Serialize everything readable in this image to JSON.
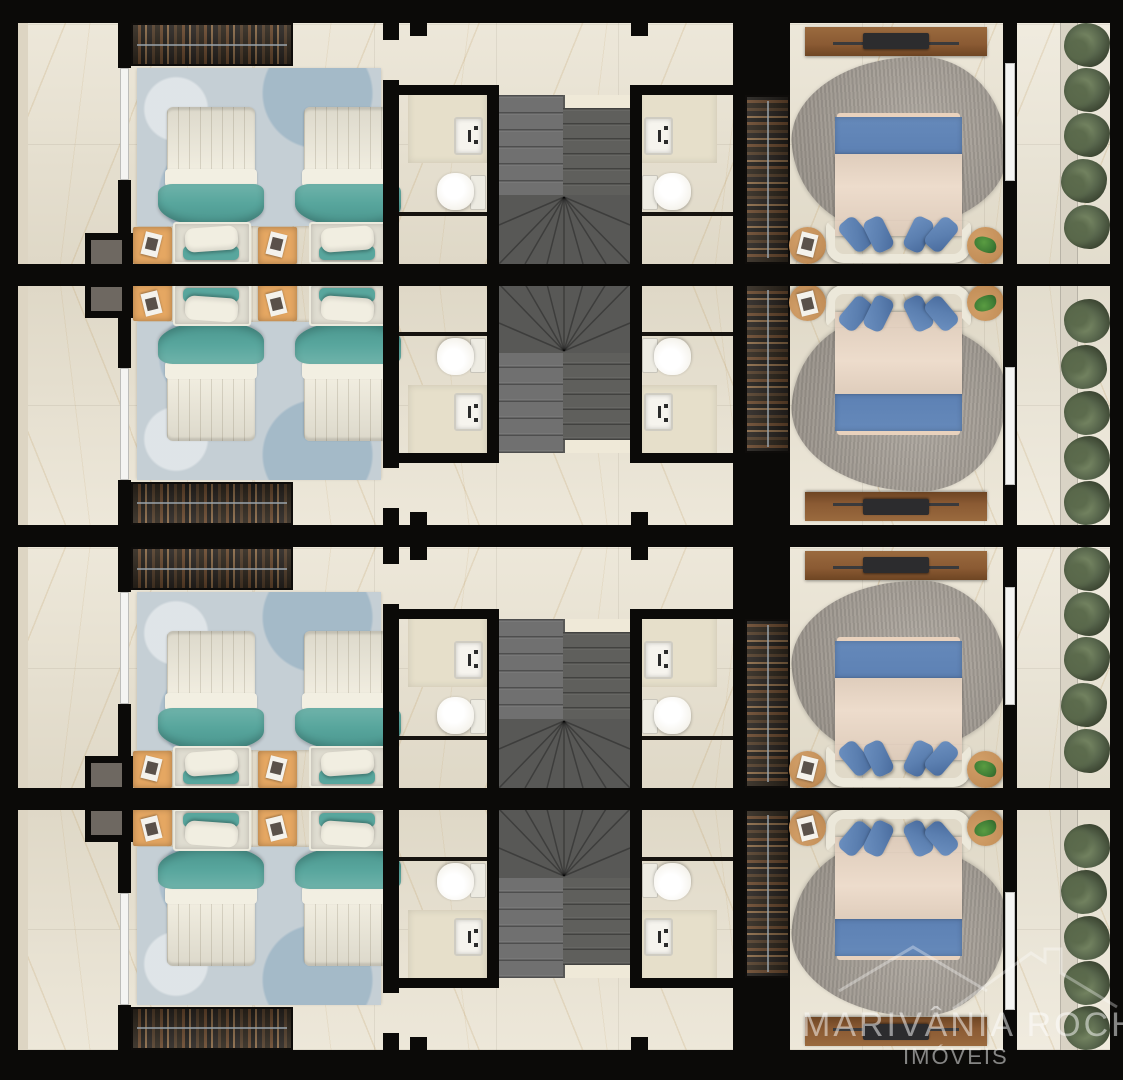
{
  "watermark": {
    "line1": "MARIVÂNIA ROCHA",
    "line2": "IMÓVEIS",
    "logo": "double-roof-outline-logo"
  },
  "colors": {
    "wall": "#0b0a08",
    "floor": "#e8e1cf",
    "floorLight": "#ece6d6",
    "floorEdge": "#ddd5c3",
    "rugTwin": "#c5cfd5",
    "teal": "#58a69d",
    "tealDark": "#4a958d",
    "duvet": "#efebdc",
    "platform": "#dfdcd0",
    "pillow": "#f1eee1",
    "nightstand": "#e5a762",
    "wardrobe": "#262120",
    "stair": "#707070",
    "stairDark": "#585856",
    "landing": "#efe9d8",
    "porcelain": "#f6f4ee",
    "counter": "#e6dfca",
    "masterBed": "#ebd8c6",
    "blueBand": "#5d81b4",
    "bluePillow": "#5b7fb0",
    "masterRug": "#a9a299",
    "wood": "#8a5a33",
    "tv": "#2c2c2e",
    "tableWood": "#c28e58",
    "plantGreen": "#3f7d35",
    "hedge": "#55634a",
    "hedgeLight": "#71815f",
    "planter": "#d9d3c5",
    "shaft": "#6e6861",
    "glass": "#f4f4f2",
    "watermarkText": "#ffffff"
  },
  "plan": {
    "type": "residential floor plan render, top-down 3D",
    "rows": [
      {
        "id": "unit-1",
        "flipped": false
      },
      {
        "id": "unit-2",
        "flipped": true
      },
      {
        "id": "unit-3",
        "flipped": false
      },
      {
        "id": "unit-4",
        "flipped": true
      }
    ],
    "rooms_per_unit": [
      "hallway",
      "twin-bedroom",
      "bathroom-left",
      "staircase",
      "bathroom-right",
      "walk-in-closet",
      "master-bedroom",
      "balcony-garden"
    ],
    "furniture_per_unit": {
      "twin_bedroom": [
        "wardrobe-with-clothes",
        "twin-bed",
        "twin-bed",
        "nightstand-with-magazine",
        "nightstand-with-magazine",
        "blue-area-rug"
      ],
      "bathrooms": [
        "vanity-with-sink",
        "toilet",
        "shower-partition"
      ],
      "master_bedroom": [
        "tv-stand-with-tv",
        "double-bed-blue-runner",
        "4-blue-pillows",
        "curved-headboard",
        "round-side-table-magazine",
        "round-side-table-plant",
        "gray-organic-rug",
        "open-closet"
      ],
      "balcony": [
        "planter-strip",
        "hedge-plants-x5"
      ]
    }
  }
}
